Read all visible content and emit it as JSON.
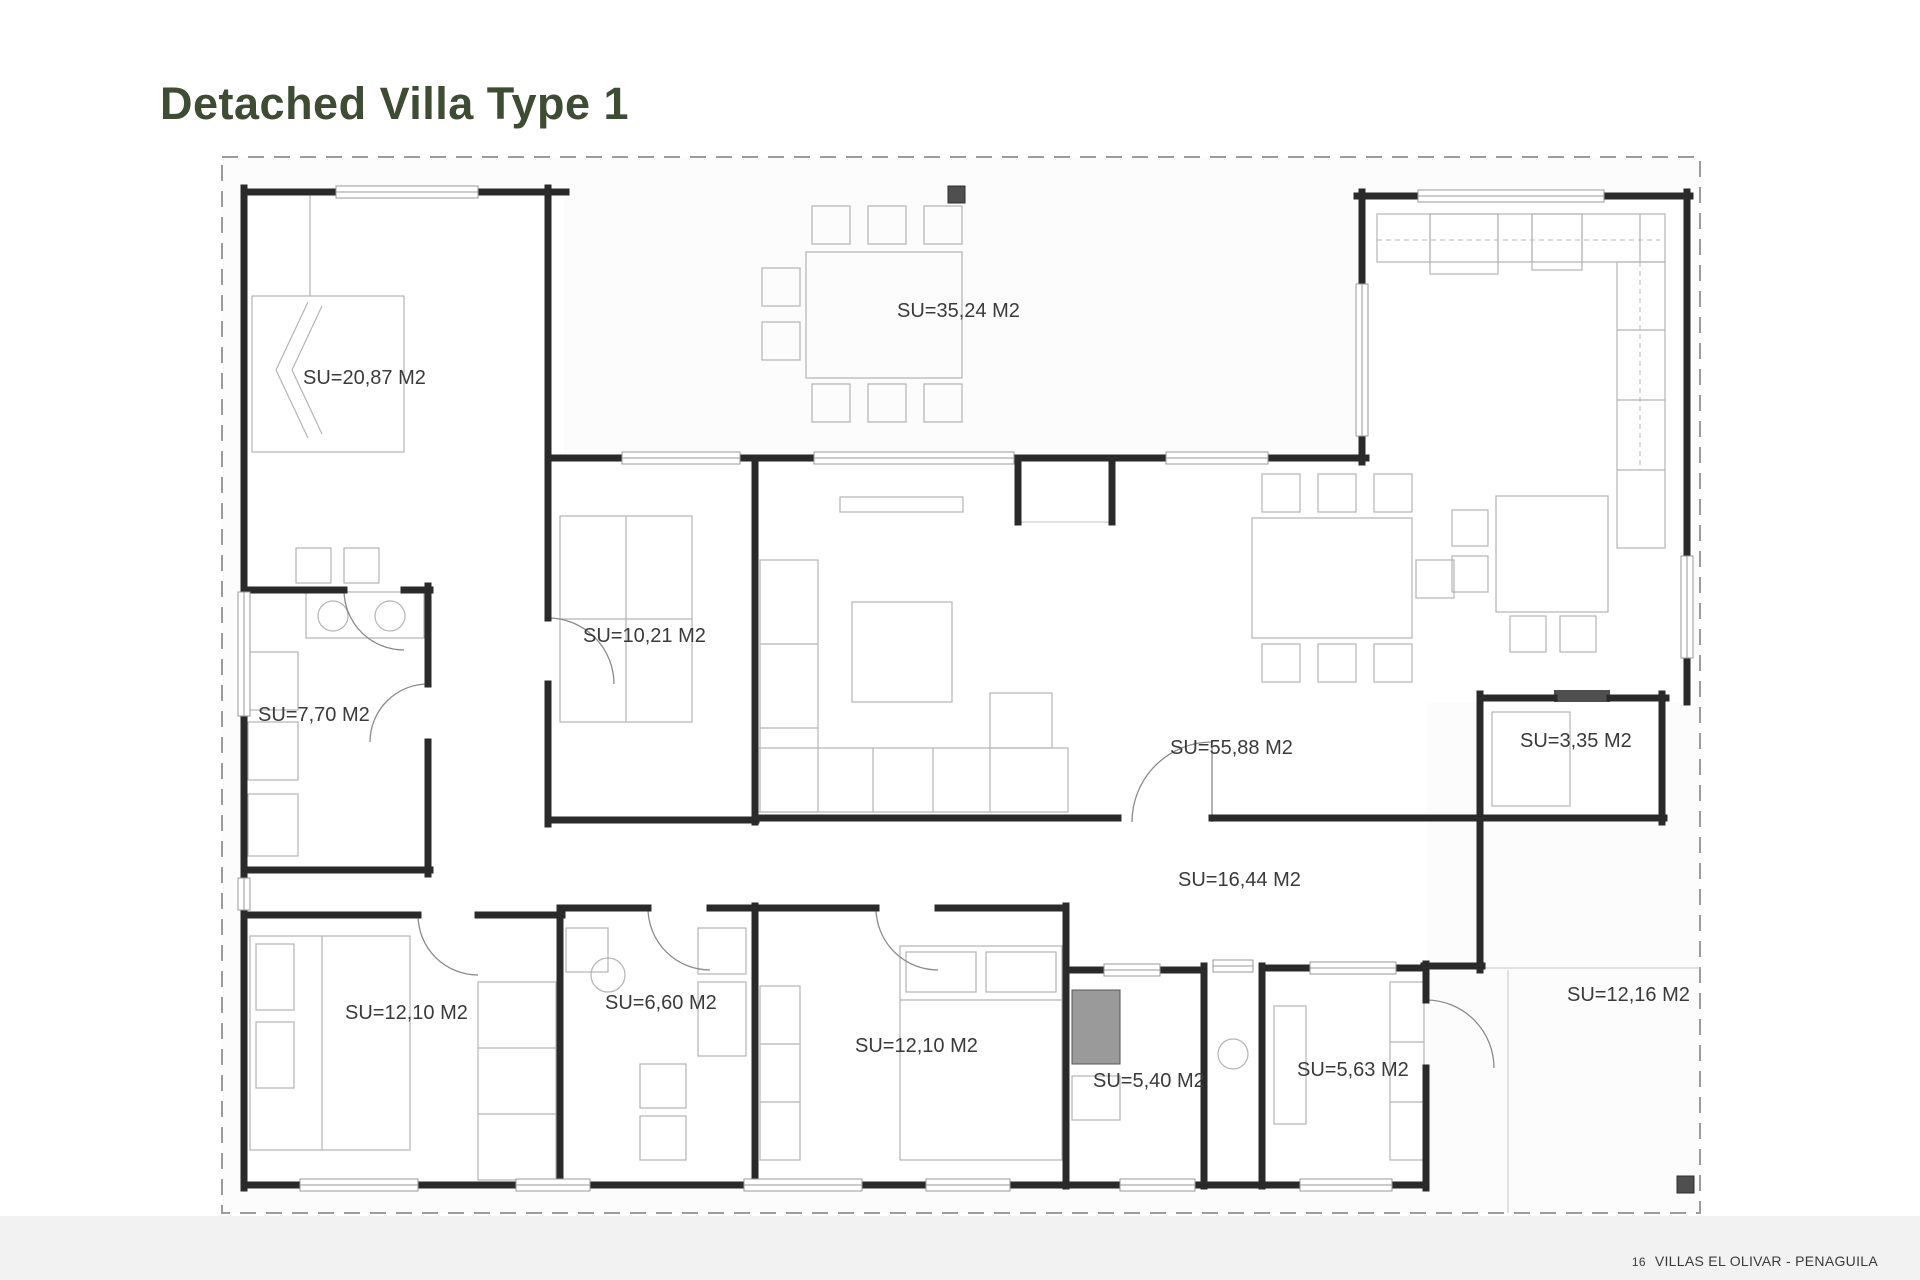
{
  "page": {
    "title": "Detached Villa Type 1",
    "footer_page_number": "16",
    "footer_text": "VILLAS EL OLIVAR - PENAGUILA"
  },
  "colors": {
    "title-green": "#3e4c34",
    "label-text": "#3a3a3a",
    "wall": "#2a2a2a",
    "window-line": "#9a9a9a",
    "furniture": "#b4b4b4",
    "door": "#8a8a8a",
    "boundary": "#9c9c9c",
    "marker": "#4f4f4f",
    "page-bg": "#ffffff",
    "plan-bg": "#fcfcfc"
  },
  "plan": {
    "unit": "M2",
    "rooms": [
      {
        "label": "SU=20,87 M2"
      },
      {
        "label": "SU=35,24 M2"
      },
      {
        "label": "SU=10,21 M2"
      },
      {
        "label": "SU=7,70 M2"
      },
      {
        "label": "SU=55,88 M2"
      },
      {
        "label": "SU=3,35 M2"
      },
      {
        "label": "SU=16,44 M2"
      },
      {
        "label": "SU=12,10 M2"
      },
      {
        "label": "SU=6,60 M2"
      },
      {
        "label": "SU=12,10 M2"
      },
      {
        "label": "SU=5,40 M2"
      },
      {
        "label": "SU=5,63 M2"
      },
      {
        "label": "SU=12,16 M2"
      }
    ]
  }
}
